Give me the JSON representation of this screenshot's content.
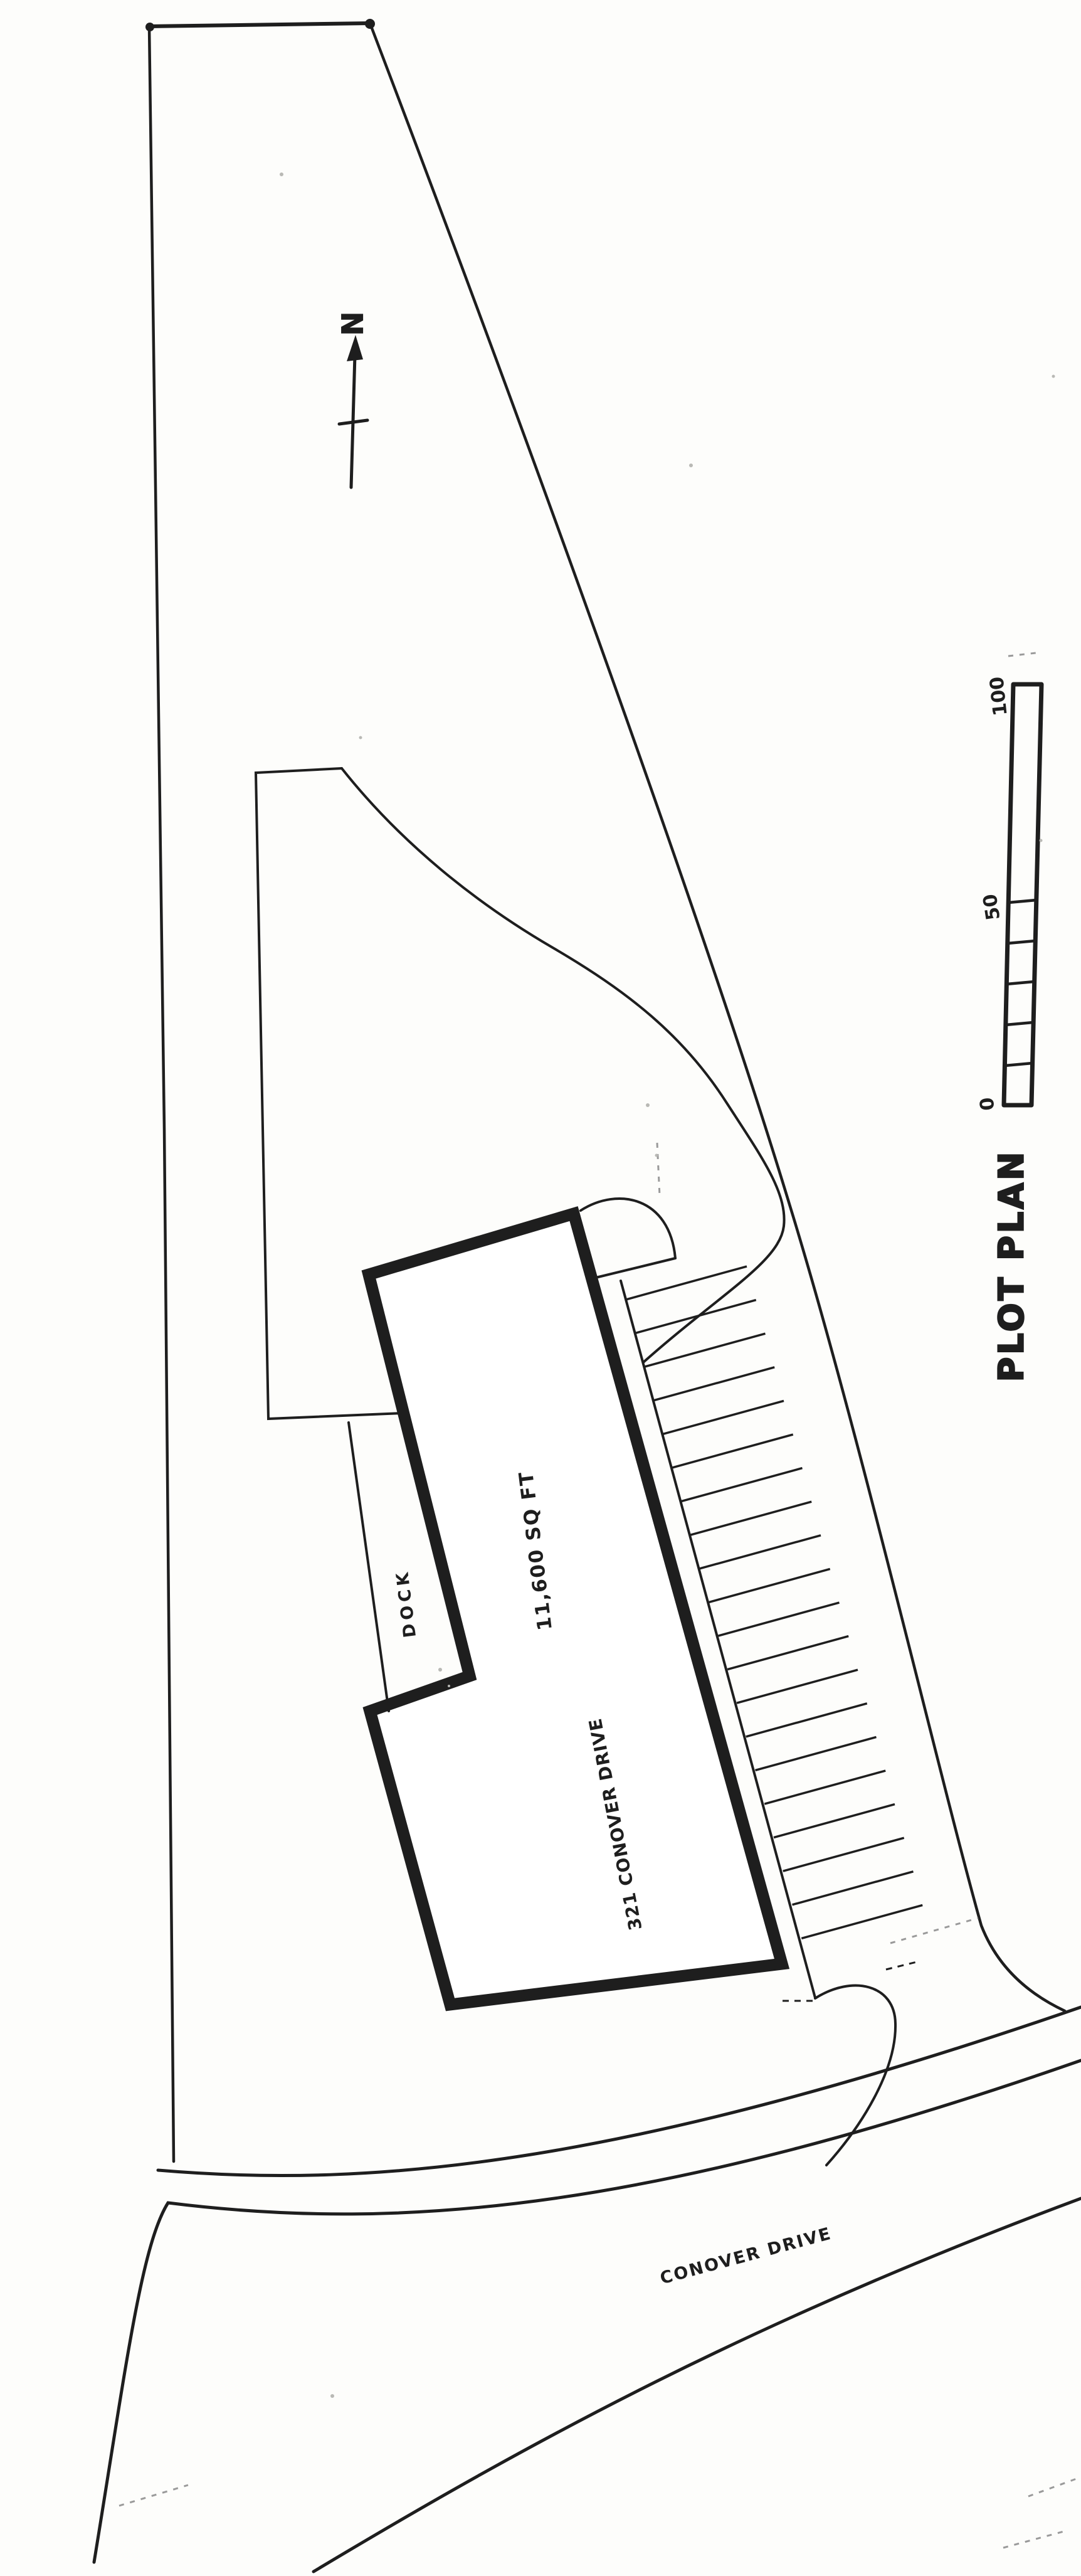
{
  "drawing": {
    "title": "PLOT PLAN",
    "north": {
      "label": "N"
    },
    "scale_bar": {
      "labels": {
        "zero": "0",
        "fifty": "50",
        "hundred": "100"
      },
      "minor_segments": 5
    },
    "building": {
      "address": "321 CONOVER DRIVE",
      "area": "11,600 SQ FT",
      "dock": "DOCK"
    },
    "street": {
      "name": "CONOVER DRIVE"
    },
    "parking": {
      "stall_count": 20
    },
    "colors": {
      "ink": "#1e1e1e",
      "faint": "#9a9a9a",
      "paper": "#fdfdfb"
    }
  }
}
